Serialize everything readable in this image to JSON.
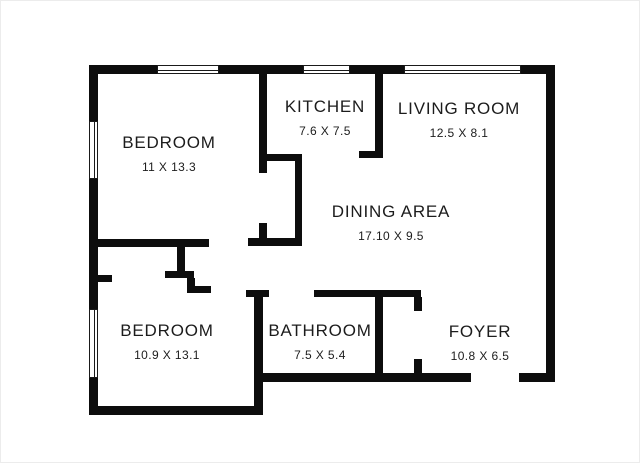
{
  "floorplan": {
    "background": "#ffffff",
    "wall_color": "#0d0d0d",
    "text_color": "#1c1c1c",
    "rooms": [
      {
        "id": "bedroom-1",
        "name": "BEDROOM",
        "dims": "11 X 13.3"
      },
      {
        "id": "kitchen",
        "name": "KITCHEN",
        "dims": "7.6 X 7.5"
      },
      {
        "id": "living-room",
        "name": "LIVING ROOM",
        "dims": "12.5 X 8.1"
      },
      {
        "id": "dining-area",
        "name": "DINING AREA",
        "dims": "17.10 X 9.5"
      },
      {
        "id": "bedroom-2",
        "name": "BEDROOM",
        "dims": "10.9 X 13.1"
      },
      {
        "id": "bathroom",
        "name": "BATHROOM",
        "dims": "7.5 X 5.4"
      },
      {
        "id": "foyer",
        "name": "FOYER",
        "dims": "10.8 X 6.5"
      }
    ],
    "walls": {
      "exterior": [
        {
          "x": 88,
          "y": 64,
          "w": 466,
          "h": 9
        },
        {
          "x": 88,
          "y": 64,
          "w": 9,
          "h": 350
        },
        {
          "x": 545,
          "y": 64,
          "w": 9,
          "h": 317
        },
        {
          "x": 88,
          "y": 405,
          "w": 174,
          "h": 9
        },
        {
          "x": 253,
          "y": 289,
          "w": 9,
          "h": 125
        },
        {
          "x": 253,
          "y": 372,
          "w": 217,
          "h": 9
        },
        {
          "x": 518,
          "y": 372,
          "w": 36,
          "h": 9
        }
      ],
      "interior": [
        {
          "x": 258,
          "y": 73,
          "w": 8,
          "h": 99
        },
        {
          "x": 262,
          "y": 153,
          "w": 39,
          "h": 7
        },
        {
          "x": 294,
          "y": 153,
          "w": 7,
          "h": 91
        },
        {
          "x": 374,
          "y": 73,
          "w": 8,
          "h": 84
        },
        {
          "x": 358,
          "y": 150,
          "w": 24,
          "h": 7
        },
        {
          "x": 88,
          "y": 238,
          "w": 120,
          "h": 8
        },
        {
          "x": 247,
          "y": 237,
          "w": 54,
          "h": 8
        },
        {
          "x": 258,
          "y": 222,
          "w": 8,
          "h": 18
        },
        {
          "x": 176,
          "y": 245,
          "w": 8,
          "h": 27
        },
        {
          "x": 164,
          "y": 270,
          "w": 29,
          "h": 7
        },
        {
          "x": 186,
          "y": 277,
          "w": 8,
          "h": 10
        },
        {
          "x": 186,
          "y": 285,
          "w": 24,
          "h": 7
        },
        {
          "x": 97,
          "y": 274,
          "w": 14,
          "h": 7
        },
        {
          "x": 245,
          "y": 289,
          "w": 23,
          "h": 7
        },
        {
          "x": 313,
          "y": 289,
          "w": 107,
          "h": 7
        },
        {
          "x": 374,
          "y": 296,
          "w": 8,
          "h": 76
        },
        {
          "x": 413,
          "y": 296,
          "w": 8,
          "h": 14
        },
        {
          "x": 413,
          "y": 358,
          "w": 8,
          "h": 14
        }
      ]
    },
    "windows": [
      {
        "x": 156,
        "y": 64,
        "w": 62,
        "h": 9,
        "o": "h"
      },
      {
        "x": 302,
        "y": 64,
        "w": 47,
        "h": 9,
        "o": "h"
      },
      {
        "x": 403,
        "y": 64,
        "w": 117,
        "h": 9,
        "o": "h"
      },
      {
        "x": 88,
        "y": 120,
        "w": 9,
        "h": 58,
        "o": "v"
      },
      {
        "x": 88,
        "y": 308,
        "w": 9,
        "h": 69,
        "o": "v"
      }
    ],
    "door_openings": [
      {
        "side": "bottom-entry",
        "x": 470,
        "y": 372,
        "w": 48,
        "h": 9
      }
    ]
  }
}
